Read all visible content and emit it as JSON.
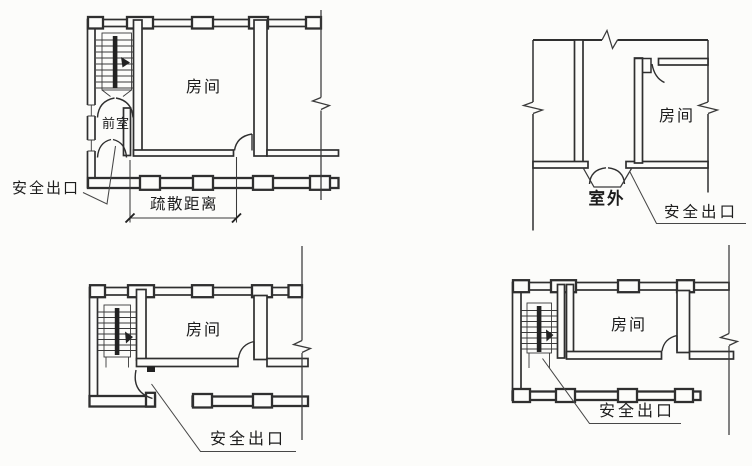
{
  "figure": {
    "description_colors": {
      "background": "#fcfcfa",
      "line": "#2f2f2f",
      "text": "#1d1d1d"
    }
  },
  "plans": {
    "top_left": {
      "room_label": "房间",
      "vestibule_label": "前室",
      "exit_label": "安全出口",
      "distance_label": "疏散距离"
    },
    "top_right": {
      "room_label": "房间",
      "outdoor_label": "室外",
      "exit_label": "安全出口"
    },
    "bottom_left": {
      "room_label": "房间",
      "exit_label": "安全出口"
    },
    "bottom_right": {
      "room_label": "房间",
      "exit_label": "安全出口"
    }
  }
}
